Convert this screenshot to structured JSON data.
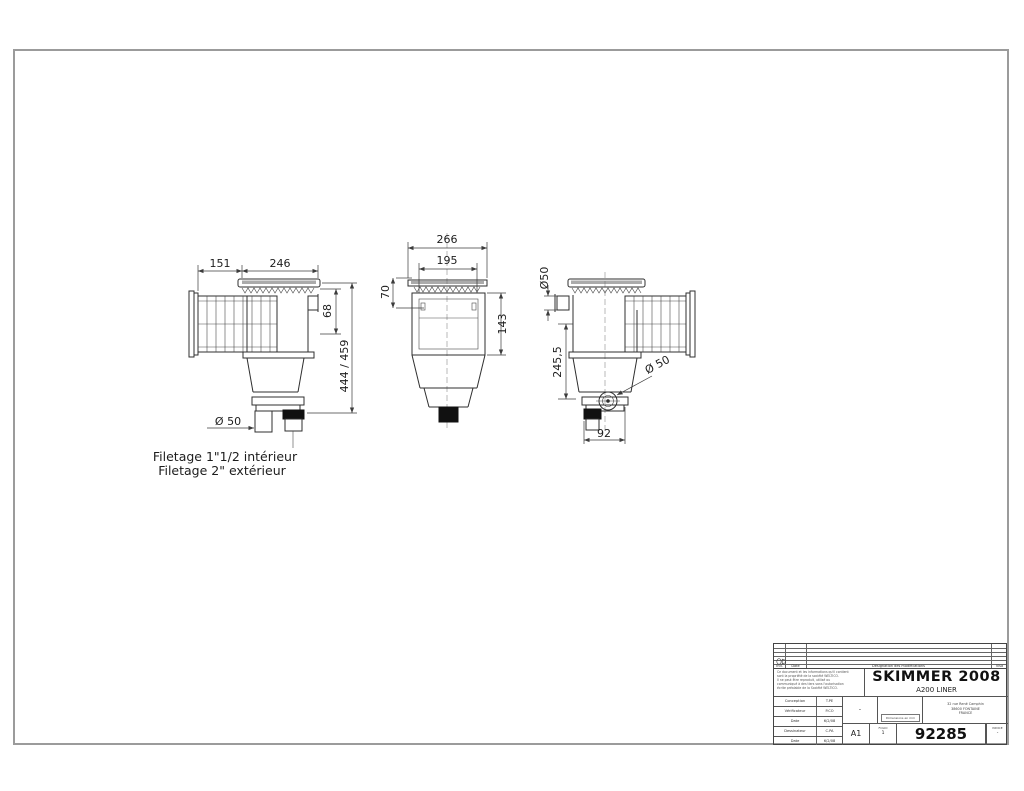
{
  "sheet": {
    "bg": "#ffffff",
    "border_color": "#9b9b9b"
  },
  "views": {
    "left": {
      "dims": {
        "width_throat": "151",
        "width_cover": "246",
        "height_mouth": "68",
        "height_overall": "444 / 459",
        "diameter_bottom": "Ø 50"
      },
      "notes": {
        "thread_line1": "Filetage 1\"1/2 intérieur",
        "thread_line2": "Filetage 2\" extérieur"
      }
    },
    "front": {
      "dims": {
        "width_overall": "266",
        "width_opening": "195",
        "height_lip": "70",
        "height_opening": "143"
      }
    },
    "right": {
      "dims": {
        "diameter_top_stub": "Ø50",
        "height_to_port": "245,5",
        "diameter_side_port": "Ø 50",
        "offset_bottom": "92"
      }
    }
  },
  "titleblock": {
    "revision": {
      "ind_label": "Ind.",
      "date_label": "Date",
      "designation_label": "Désignation des modifications",
      "visa_label": "Visa"
    },
    "legal": [
      "Ce document et les informations qu'il contient",
      "sont la propriété de la société WELTICO.",
      "Il ne peut être reproduit, utilisé ou",
      "communiqué à des tiers sans l'autorisation",
      "écrite préalable de la Société WELTICO."
    ],
    "fields": [
      {
        "label": "Conception",
        "value": "T.PE"
      },
      {
        "label": "Vérificateur",
        "value": "P.CO"
      },
      {
        "label": "Date",
        "value": "6/2/08"
      },
      {
        "label": "Dessinateur",
        "value": "C.PA"
      },
      {
        "label": "Date",
        "value": "6/2/08"
      }
    ],
    "title": "SKIMMER 2008",
    "subtitle": "A200 LINER",
    "scale": "-",
    "units_note": "Dimensions en mm",
    "address": [
      "32 rue René Camphin",
      "38600 FONTAINE",
      "FRANCE"
    ],
    "format": "A1",
    "folio_label": "FOLIO",
    "folio_value": "1",
    "drawing_number": "92285",
    "indice_label": "INDICE",
    "indice_value": "-"
  }
}
